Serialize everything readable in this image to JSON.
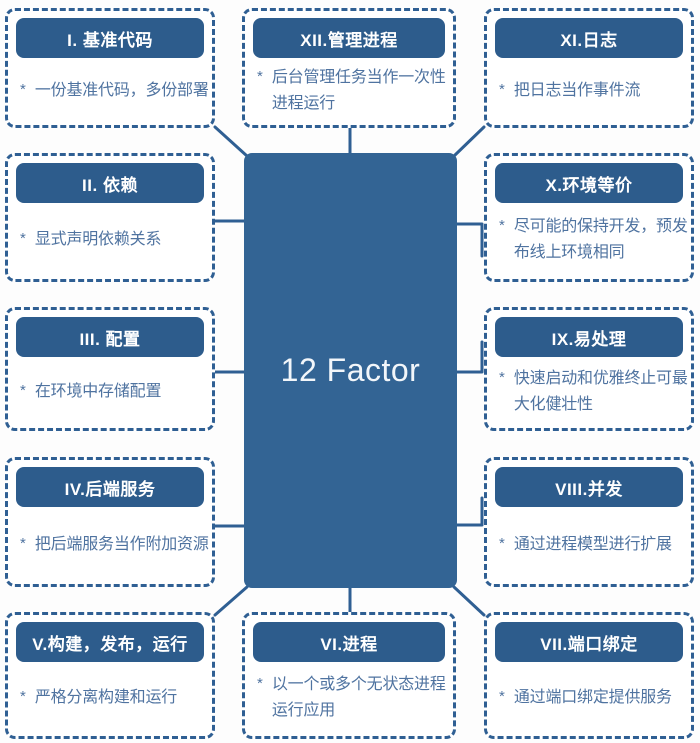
{
  "title": "12 Factor",
  "bullet": "*",
  "center": {
    "label": "12 Factor"
  },
  "nodes": [
    {
      "id": "factor-1",
      "title": "I. 基准代码",
      "desc": "一份基准代码，多份部署"
    },
    {
      "id": "factor-2",
      "title": "II. 依赖",
      "desc": "显式声明依赖关系"
    },
    {
      "id": "factor-3",
      "title": "III. 配置",
      "desc": "在环境中存储配置"
    },
    {
      "id": "factor-4",
      "title": "IV.后端服务",
      "desc": "把后端服务当作附加资源"
    },
    {
      "id": "factor-5",
      "title": "V.构建，发布，运行",
      "desc": "严格分离构建和运行"
    },
    {
      "id": "factor-6",
      "title": "VI.进程",
      "desc": "以一个或多个无状态进程\n运行应用"
    },
    {
      "id": "factor-7",
      "title": "VII.端口绑定",
      "desc": "通过端口绑定提供服务"
    },
    {
      "id": "factor-8",
      "title": "VIII.并发",
      "desc": "通过进程模型进行扩展"
    },
    {
      "id": "factor-9",
      "title": "IX.易处理",
      "desc": "快速启动和优雅终止可最\n大化健壮性"
    },
    {
      "id": "factor-10",
      "title": "X.环境等价",
      "desc": "尽可能的保持开发，预发\n布线上环境相同"
    },
    {
      "id": "factor-11",
      "title": "XI.日志",
      "desc": "把日志当作事件流"
    },
    {
      "id": "factor-12",
      "title": "XII.管理进程",
      "desc": "后台管理任务当作一次性\n进程运行"
    }
  ],
  "colors": {
    "background": "#fdfdfd",
    "dashed_border": "#2f5f93",
    "header_bg": "#2d5c8c",
    "header_text": "#ffffff",
    "desc_text": "#4f73a0",
    "center_bg": "#336494",
    "center_text": "#f2f6fa",
    "connector": "#2f5f93"
  }
}
